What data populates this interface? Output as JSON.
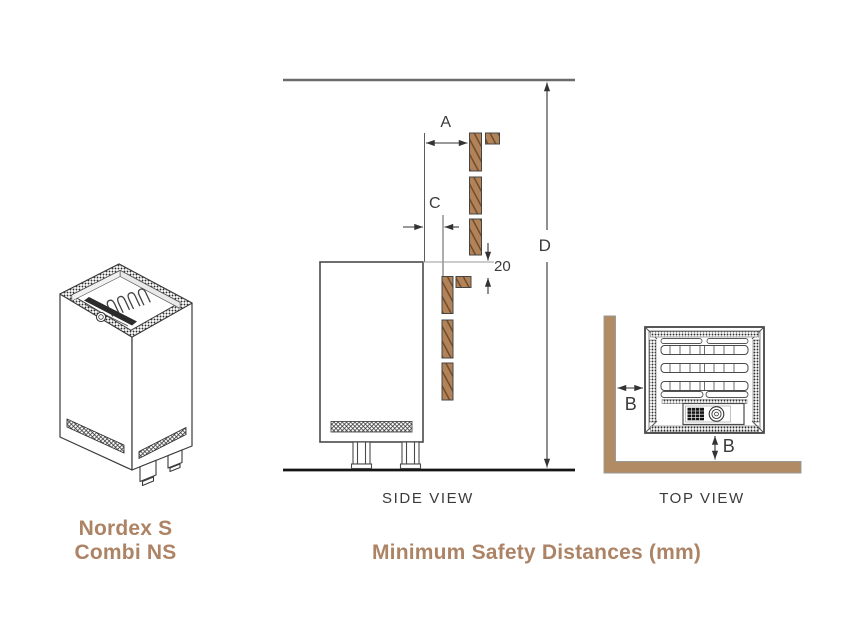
{
  "page": {
    "background": "#ffffff"
  },
  "colors": {
    "accent_text": "#AD8365",
    "diagram_line": "#3A3A3A",
    "wood_fill": "#B28359",
    "wood_grain": "#6E4B2B",
    "wall_fill": "#B18B64"
  },
  "left_panel": {
    "product_name_line1": "Nordex S",
    "product_name_line2": "Combi NS"
  },
  "side_view": {
    "caption": "SIDE VIEW",
    "dim_a": "A",
    "dim_c": "C",
    "dim_d": "D",
    "dim_gap_20": "20"
  },
  "top_view": {
    "caption": "TOP VIEW",
    "dim_b_wall": "B",
    "dim_b_rear": "B"
  },
  "footer": {
    "title": "Minimum Safety Distances (mm)"
  }
}
